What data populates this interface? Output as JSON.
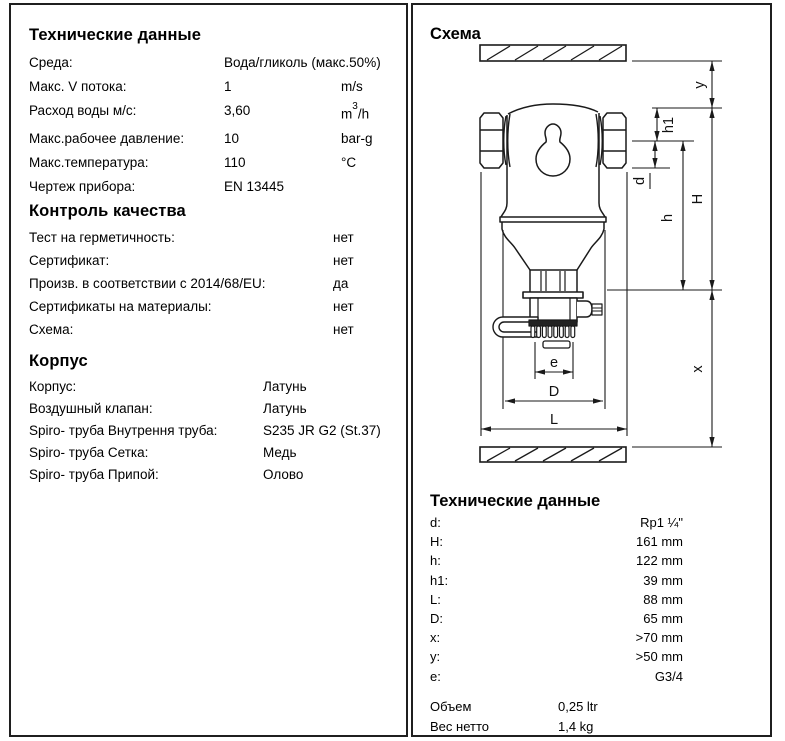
{
  "left_panel": {
    "sections": [
      {
        "title": "Технические данные",
        "rows": [
          {
            "label": "Среда:",
            "value": "Вода/гликоль (макс.50%)",
            "unit": ""
          },
          {
            "label": "Макс. V потока:",
            "value": "1",
            "unit": "m/s"
          },
          {
            "label": "Расход воды м/с:",
            "value": "3,60",
            "unit_base": "m",
            "unit_sup": "3",
            "unit_rest": "/h"
          },
          {
            "label": "Макс.рабочее давление:",
            "value": "10",
            "unit": "bar-g"
          },
          {
            "label": "Макс.температура:",
            "value": "110",
            "unit": "°C"
          },
          {
            "label": "Чертеж прибора:",
            "value": "EN 13445",
            "unit": ""
          }
        ]
      },
      {
        "title": "Контроль качества",
        "rows": [
          {
            "label": "Тест на герметичность:",
            "value": "нет"
          },
          {
            "label": "Сертификат:",
            "value": "нет"
          },
          {
            "label": "Произв. в соответствии с 2014/68/EU:",
            "value": "да"
          },
          {
            "label": "Сертификаты на материалы:",
            "value": "нет"
          },
          {
            "label": "Схема:",
            "value": "нет"
          }
        ]
      },
      {
        "title": "Корпус",
        "rows": [
          {
            "label": "Корпус:",
            "value": "Латунь"
          },
          {
            "label": "Воздушный клапан:",
            "value": "Латунь"
          },
          {
            "label": "Spiro- труба Внутрення труба:",
            "value": "S235 JR G2 (St.37)"
          },
          {
            "label": "Spiro- труба Сетка:",
            "value": "Медь"
          },
          {
            "label": "Spiro- труба Припой:",
            "value": "Олово"
          }
        ]
      }
    ]
  },
  "right_panel": {
    "schema_title": "Схема",
    "tech_title": "Технические данные",
    "diagram_labels": {
      "y": "y",
      "h1": "h1",
      "d": "d",
      "h": "h",
      "H": "H",
      "x": "x",
      "e": "e",
      "D": "D",
      "L": "L"
    },
    "dims": [
      {
        "label": "d:",
        "value": "Rp1 ¼\""
      },
      {
        "label": "H:",
        "value": "161 mm"
      },
      {
        "label": "h:",
        "value": "122 mm"
      },
      {
        "label": "h1:",
        "value": "39 mm"
      },
      {
        "label": "L:",
        "value": "88 mm"
      },
      {
        "label": "D:",
        "value": "65 mm"
      },
      {
        "label": "x:",
        "value": ">70 mm"
      },
      {
        "label": "y:",
        "value": ">50 mm"
      },
      {
        "label": "e:",
        "value": "G3/4"
      }
    ],
    "extras": [
      {
        "label": "Объем",
        "value": "0,25 ltr"
      },
      {
        "label": "Вес нетто",
        "value": "1,4 kg"
      }
    ]
  }
}
